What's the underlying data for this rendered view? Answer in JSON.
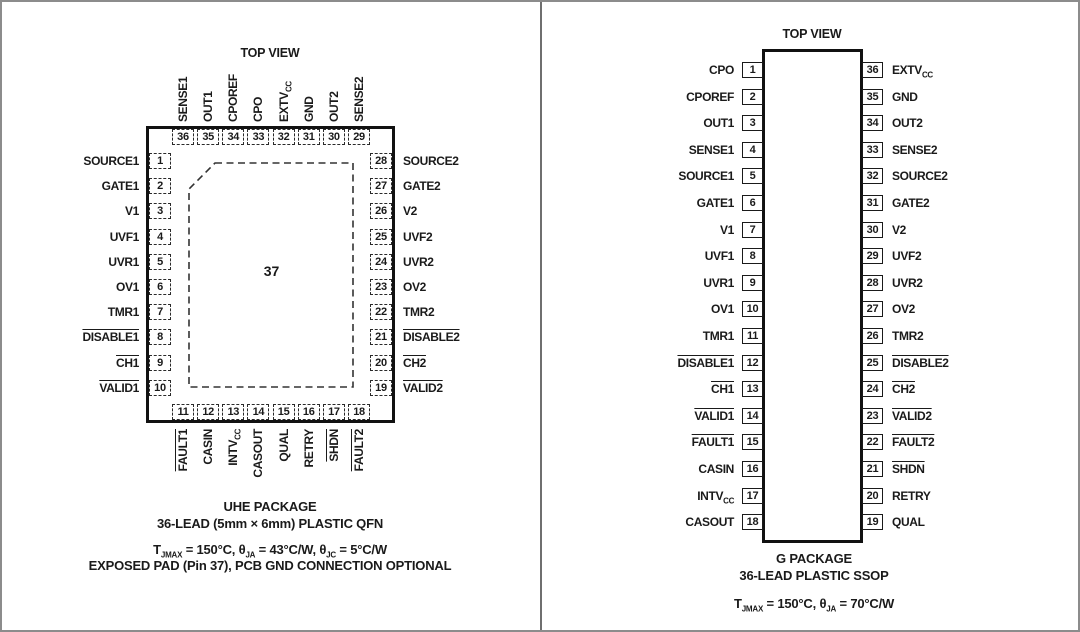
{
  "colors": {
    "ink": "#1a1a1a",
    "package_border": "#111111",
    "frame_gray": "#8c8c8c",
    "divider_gray": "#6f6f6f",
    "background": "#ffffff"
  },
  "left_panel": {
    "top_view": "TOP VIEW",
    "center_pad_number": "37",
    "pins": {
      "top": [
        {
          "num": "36",
          "label": "SENSE1"
        },
        {
          "num": "35",
          "label": "OUT1"
        },
        {
          "num": "34",
          "label": "CPOREF"
        },
        {
          "num": "33",
          "label": "CPO"
        },
        {
          "num": "32",
          "label": "EXTV_{CC}"
        },
        {
          "num": "31",
          "label": "GND"
        },
        {
          "num": "30",
          "label": "OUT2"
        },
        {
          "num": "29",
          "label": "SENSE2"
        }
      ],
      "left": [
        {
          "num": "1",
          "label": "SOURCE1"
        },
        {
          "num": "2",
          "label": "GATE1"
        },
        {
          "num": "3",
          "label": "V1"
        },
        {
          "num": "4",
          "label": "UVF1"
        },
        {
          "num": "5",
          "label": "UVR1"
        },
        {
          "num": "6",
          "label": "OV1"
        },
        {
          "num": "7",
          "label": "TMR1"
        },
        {
          "num": "8",
          "label": "DISABLE1",
          "bar": true
        },
        {
          "num": "9",
          "label": "CH1",
          "bar": true
        },
        {
          "num": "10",
          "label": "VALID1",
          "bar": true
        }
      ],
      "right": [
        {
          "num": "28",
          "label": "SOURCE2"
        },
        {
          "num": "27",
          "label": "GATE2"
        },
        {
          "num": "26",
          "label": "V2"
        },
        {
          "num": "25",
          "label": "UVF2"
        },
        {
          "num": "24",
          "label": "UVR2"
        },
        {
          "num": "23",
          "label": "OV2"
        },
        {
          "num": "22",
          "label": "TMR2"
        },
        {
          "num": "21",
          "label": "DISABLE2",
          "bar": true
        },
        {
          "num": "20",
          "label": "CH2",
          "bar": true
        },
        {
          "num": "19",
          "label": "VALID2",
          "bar": true
        }
      ],
      "bottom": [
        {
          "num": "11",
          "label": "FAULT1",
          "bar": true
        },
        {
          "num": "12",
          "label": "CASIN"
        },
        {
          "num": "13",
          "label": "INTV_{CC}"
        },
        {
          "num": "14",
          "label": "CASOUT"
        },
        {
          "num": "15",
          "label": "QUAL"
        },
        {
          "num": "16",
          "label": "RETRY"
        },
        {
          "num": "17",
          "label": "SHDN",
          "bar": true
        },
        {
          "num": "18",
          "label": "FAULT2",
          "bar": true
        }
      ]
    },
    "caption": [
      "UHE PACKAGE",
      "36-LEAD (5mm × 6mm) PLASTIC QFN"
    ],
    "thermal": "T_{JMAX} = 150°C, θ_{JA} = 43°C/W, θ_{JC} = 5°C/W",
    "note": "EXPOSED PAD (Pin 37), PCB GND CONNECTION OPTIONAL"
  },
  "right_panel": {
    "top_view": "TOP VIEW",
    "pins": {
      "left": [
        {
          "num": "1",
          "label": "CPO"
        },
        {
          "num": "2",
          "label": "CPOREF"
        },
        {
          "num": "3",
          "label": "OUT1"
        },
        {
          "num": "4",
          "label": "SENSE1"
        },
        {
          "num": "5",
          "label": "SOURCE1"
        },
        {
          "num": "6",
          "label": "GATE1"
        },
        {
          "num": "7",
          "label": "V1"
        },
        {
          "num": "8",
          "label": "UVF1"
        },
        {
          "num": "9",
          "label": "UVR1"
        },
        {
          "num": "10",
          "label": "OV1"
        },
        {
          "num": "11",
          "label": "TMR1"
        },
        {
          "num": "12",
          "label": "DISABLE1",
          "bar": true
        },
        {
          "num": "13",
          "label": "CH1",
          "bar": true
        },
        {
          "num": "14",
          "label": "VALID1",
          "bar": true
        },
        {
          "num": "15",
          "label": "FAULT1",
          "bar": true
        },
        {
          "num": "16",
          "label": "CASIN"
        },
        {
          "num": "17",
          "label": "INTV_{CC}"
        },
        {
          "num": "18",
          "label": "CASOUT"
        }
      ],
      "right": [
        {
          "num": "36",
          "label": "EXTV_{CC}"
        },
        {
          "num": "35",
          "label": "GND"
        },
        {
          "num": "34",
          "label": "OUT2"
        },
        {
          "num": "33",
          "label": "SENSE2"
        },
        {
          "num": "32",
          "label": "SOURCE2"
        },
        {
          "num": "31",
          "label": "GATE2"
        },
        {
          "num": "30",
          "label": "V2"
        },
        {
          "num": "29",
          "label": "UVF2"
        },
        {
          "num": "28",
          "label": "UVR2"
        },
        {
          "num": "27",
          "label": "OV2"
        },
        {
          "num": "26",
          "label": "TMR2"
        },
        {
          "num": "25",
          "label": "DISABLE2",
          "bar": true
        },
        {
          "num": "24",
          "label": "CH2",
          "bar": true
        },
        {
          "num": "23",
          "label": "VALID2",
          "bar": true
        },
        {
          "num": "22",
          "label": "FAULT2",
          "bar": true
        },
        {
          "num": "21",
          "label": "SHDN",
          "bar": true
        },
        {
          "num": "20",
          "label": "RETRY"
        },
        {
          "num": "19",
          "label": "QUAL"
        }
      ]
    },
    "caption": [
      "G PACKAGE",
      "36-LEAD PLASTIC SSOP"
    ],
    "thermal": "T_{JMAX} = 150°C, θ_{JA} = 70°C/W"
  }
}
